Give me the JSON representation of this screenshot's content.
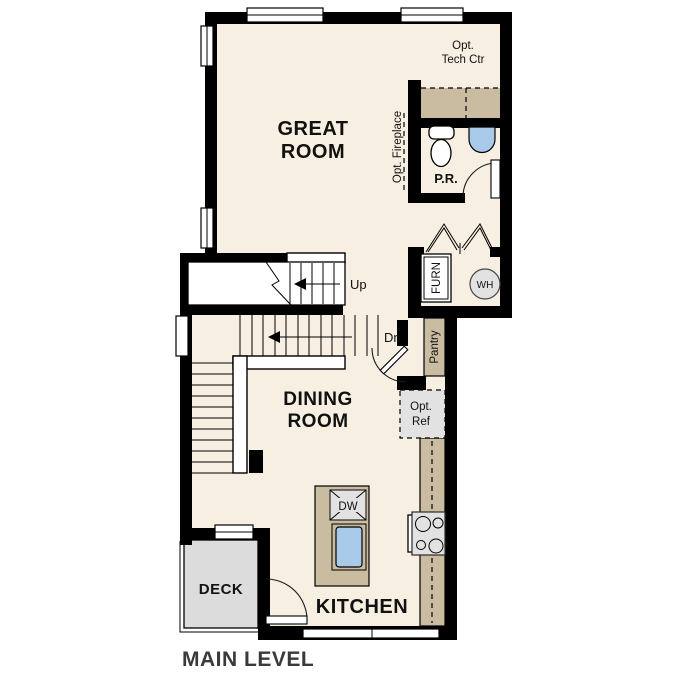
{
  "plan": {
    "title": "MAIN LEVEL",
    "rooms": {
      "great_room": {
        "line1": "GREAT",
        "line2": "ROOM"
      },
      "dining_room": {
        "line1": "DINING",
        "line2": "ROOM"
      },
      "kitchen": {
        "label": "KITCHEN"
      },
      "deck": {
        "label": "DECK"
      },
      "powder_room": {
        "label": "P.R."
      }
    },
    "annotations": {
      "opt_tech_ctr": {
        "line1": "Opt.",
        "line2": "Tech Ctr"
      },
      "opt_fireplace": "Opt. Fireplace",
      "pantry": "Pantry",
      "opt_ref": {
        "line1": "Opt.",
        "line2": "Ref"
      },
      "furnace": "FURN",
      "water_heater": "WH",
      "dishwasher": "DW",
      "stairs_up": "Up",
      "stairs_down": "Dn"
    },
    "colors": {
      "floor": "#f7efe2",
      "wall": "#000000",
      "counter": "#c9bca1",
      "deck": "#dcdcdc",
      "appliance": "#e2e2e2",
      "fixture_blue": "#a9c9e8",
      "text": "#111111",
      "title": "#3a3a3a"
    }
  }
}
